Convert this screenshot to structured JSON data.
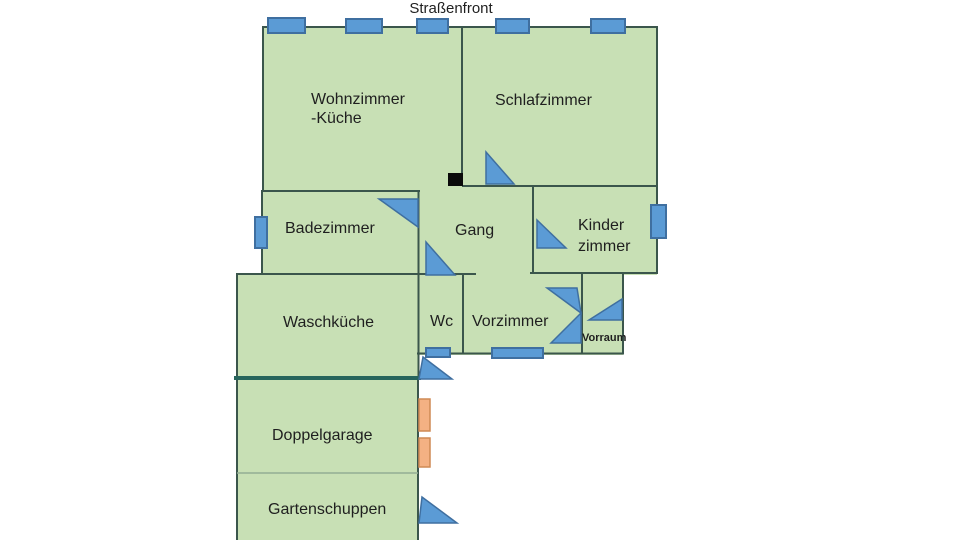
{
  "title": "Straßenfront",
  "rooms": {
    "wohnzimmer_kueche": {
      "lines": [
        "Wohnzimmer",
        "-Küche"
      ]
    },
    "schlafzimmer": {
      "label": "Schlafzimmer"
    },
    "badezimmer": {
      "label": "Badezimmer"
    },
    "gang": {
      "label": "Gang"
    },
    "kinderzimmer": {
      "lines": [
        "Kinder",
        "zimmer"
      ]
    },
    "waschkueche": {
      "label": "Waschküche"
    },
    "wc": {
      "label": "Wc"
    },
    "vorzimmer": {
      "label": "Vorzimmer"
    },
    "vorraum": {
      "label": "Vorraum"
    },
    "doppelgarage": {
      "label": "Doppelgarage"
    },
    "gartenschuppen": {
      "label": "Gartenschuppen"
    }
  },
  "colors": {
    "background": "#ffffff",
    "room_fill": "#c8e0b5",
    "wall": "#3b564c",
    "heavy_wall": "#27655c",
    "light_divider": "#93ae93",
    "window_fill": "#5b9bd5",
    "window_stroke": "#3f6fa0",
    "garage_door_fill": "#f4b183",
    "garage_door_stroke": "#cf8a55",
    "pillar": "#0a0a0a",
    "text": "#1f1f1f"
  }
}
